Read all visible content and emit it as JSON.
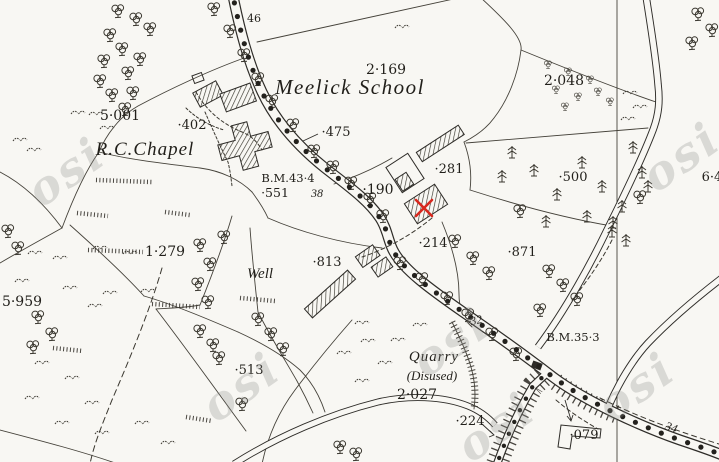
{
  "map": {
    "kind": "historic-ordnance-survey-map",
    "watermark": {
      "text": "osi"
    },
    "marker": {
      "shape": "red-cross",
      "color": "#d8281e"
    },
    "palette": {
      "paper": "#f8f7f3",
      "ink": "#2e2c28"
    },
    "labels": {
      "school": "Meelick School",
      "chapel": "R.C.Chapel",
      "well": "Well",
      "quarry": "Quarry",
      "quarry_disused": "(Disused)",
      "p2169": "2·169",
      "p2048": "2·048",
      "p5001": "5·001",
      "p402": "·402",
      "p475": "·475",
      "bm434": "B.M.43·4",
      "p551": "·551",
      "r38": "38",
      "p190": "·190",
      "p281": "·281",
      "p500": "·500",
      "p214": "·214",
      "p871": "·871",
      "p1279": "1·279",
      "p5959": "5·959",
      "p813": "·813",
      "p513": "·513",
      "p2027": "2·027",
      "p224": "·224",
      "p079": "·079",
      "r32": "32",
      "r34": "34",
      "r46": "46",
      "bm353": "B.M.35·3",
      "p64_partial": "6·4"
    }
  }
}
